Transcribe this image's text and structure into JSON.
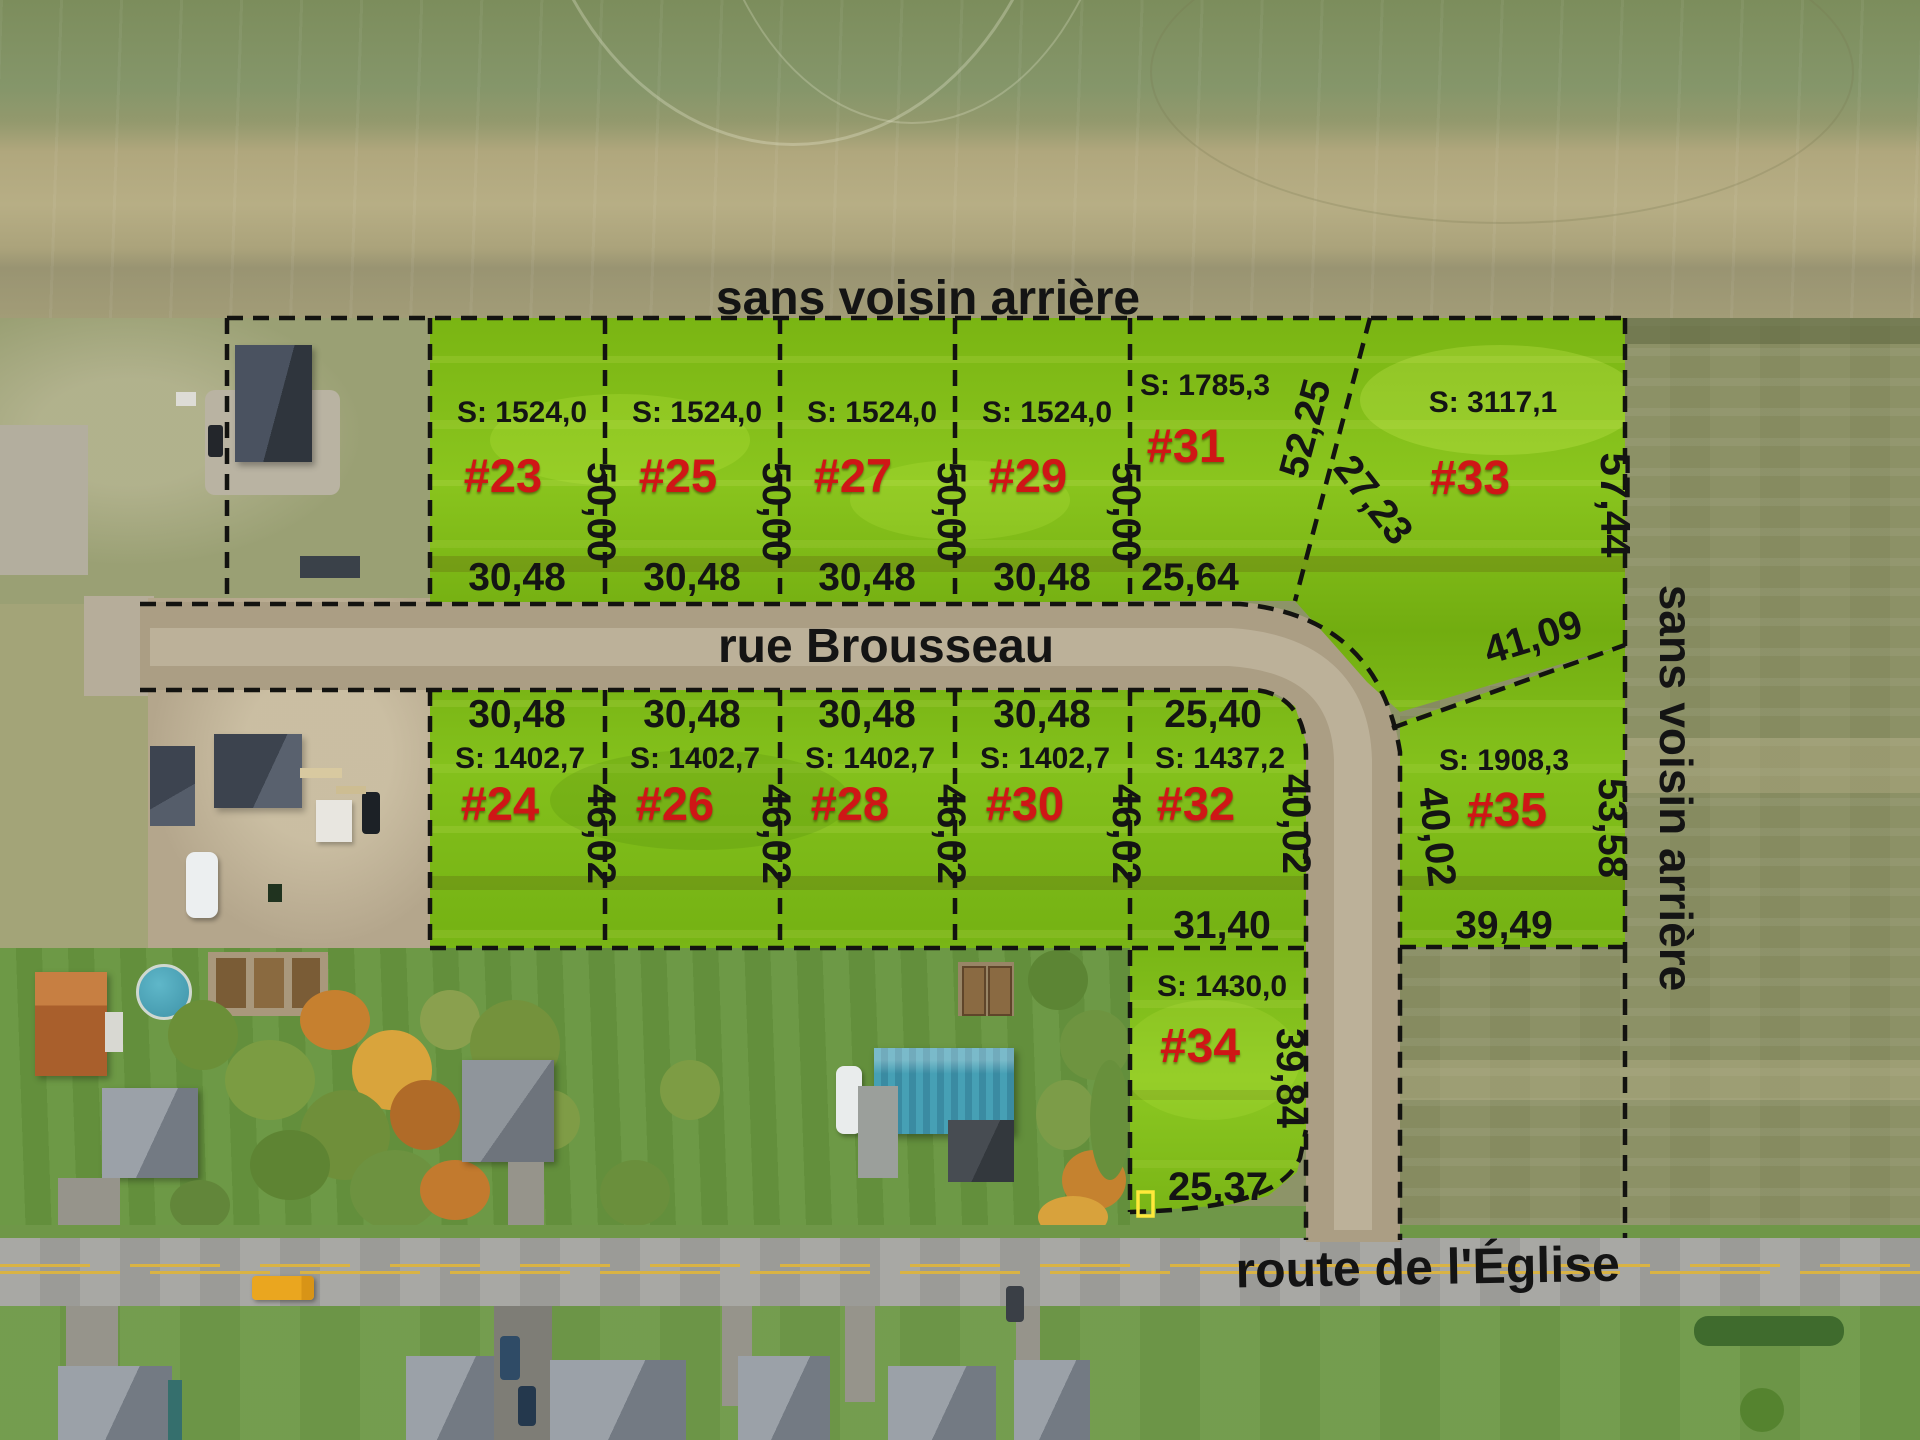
{
  "annotations": {
    "no_rear_neighbor_top": "sans voisin arrière",
    "no_rear_neighbor_right": "sans voisin arrière",
    "street_main": "rue Brousseau",
    "street_bottom": "route de l'Église"
  },
  "street_dims": {
    "curve": "27,23"
  },
  "lots": {
    "lot23": {
      "num": "#23",
      "area": "S: 1524,0",
      "depth": "50,00",
      "frontage": "30,48"
    },
    "lot25": {
      "num": "#25",
      "area": "S: 1524,0",
      "depth": "50,00",
      "frontage": "30,48"
    },
    "lot27": {
      "num": "#27",
      "area": "S: 1524,0",
      "depth": "50,00",
      "frontage": "30,48"
    },
    "lot29": {
      "num": "#29",
      "area": "S: 1524,0",
      "depth": "50,00",
      "frontage": "30,48"
    },
    "lot31": {
      "num": "#31",
      "area": "S: 1785,3",
      "frontage": "25,64",
      "side_diagonal": "52,25"
    },
    "lot33": {
      "num": "#33",
      "area": "S: 3117,1",
      "side_right": "57,44"
    },
    "lot24": {
      "num": "#24",
      "area": "S: 1402,7",
      "frontage": "30,48",
      "depth": "46,02"
    },
    "lot26": {
      "num": "#26",
      "area": "S: 1402,7",
      "frontage": "30,48",
      "depth": "46,02"
    },
    "lot28": {
      "num": "#28",
      "area": "S: 1402,7",
      "frontage": "30,48",
      "depth": "46,02"
    },
    "lot30": {
      "num": "#30",
      "area": "S: 1402,7",
      "frontage": "30,48",
      "depth": "46,02"
    },
    "lot32": {
      "num": "#32",
      "area": "S: 1437,2",
      "frontage": "25,40",
      "depth": "40,02",
      "rear": "31,40"
    },
    "lot34": {
      "num": "#34",
      "area": "S: 1430,0",
      "depth": "39,84",
      "frontage": "25,37"
    },
    "lot35": {
      "num": "#35",
      "area": "S: 1908,3",
      "side_left": "40,02",
      "side_right": "53,58",
      "rear": "41,09",
      "front": "39,49"
    }
  }
}
